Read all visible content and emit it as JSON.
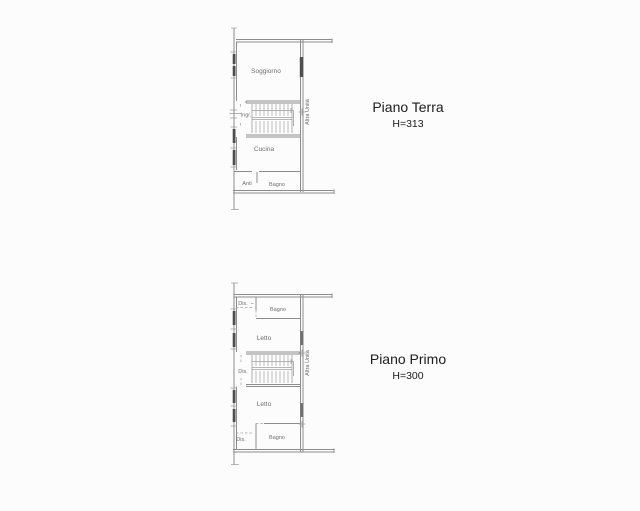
{
  "colors": {
    "background": "#fcfcfc",
    "wall_line": "#8c8c8c",
    "window_fill": "#4e4e4e",
    "room_label": "#6e6e6e",
    "title_text": "#1c1c1c"
  },
  "floor_plans": [
    {
      "title": "Piano Terra",
      "height_label": "H=313",
      "labels": {
        "soggiorno": "Soggiorno",
        "ingresso": "Ingr.",
        "cucina": "Cucina",
        "anti": "Anti",
        "bagno": "Bagno",
        "altra_unita": "Altra Unità"
      }
    },
    {
      "title": "Piano Primo",
      "height_label": "H=300",
      "labels": {
        "dis_top": "Dis.",
        "bagno_top": "Bagno",
        "letto_top": "Letto",
        "dis_mid": "Dis.",
        "letto_bottom": "Letto",
        "bagno_bottom": "Bagno",
        "dis_bottom": "Dis.",
        "altra_unita": "Altra Unità"
      }
    }
  ]
}
